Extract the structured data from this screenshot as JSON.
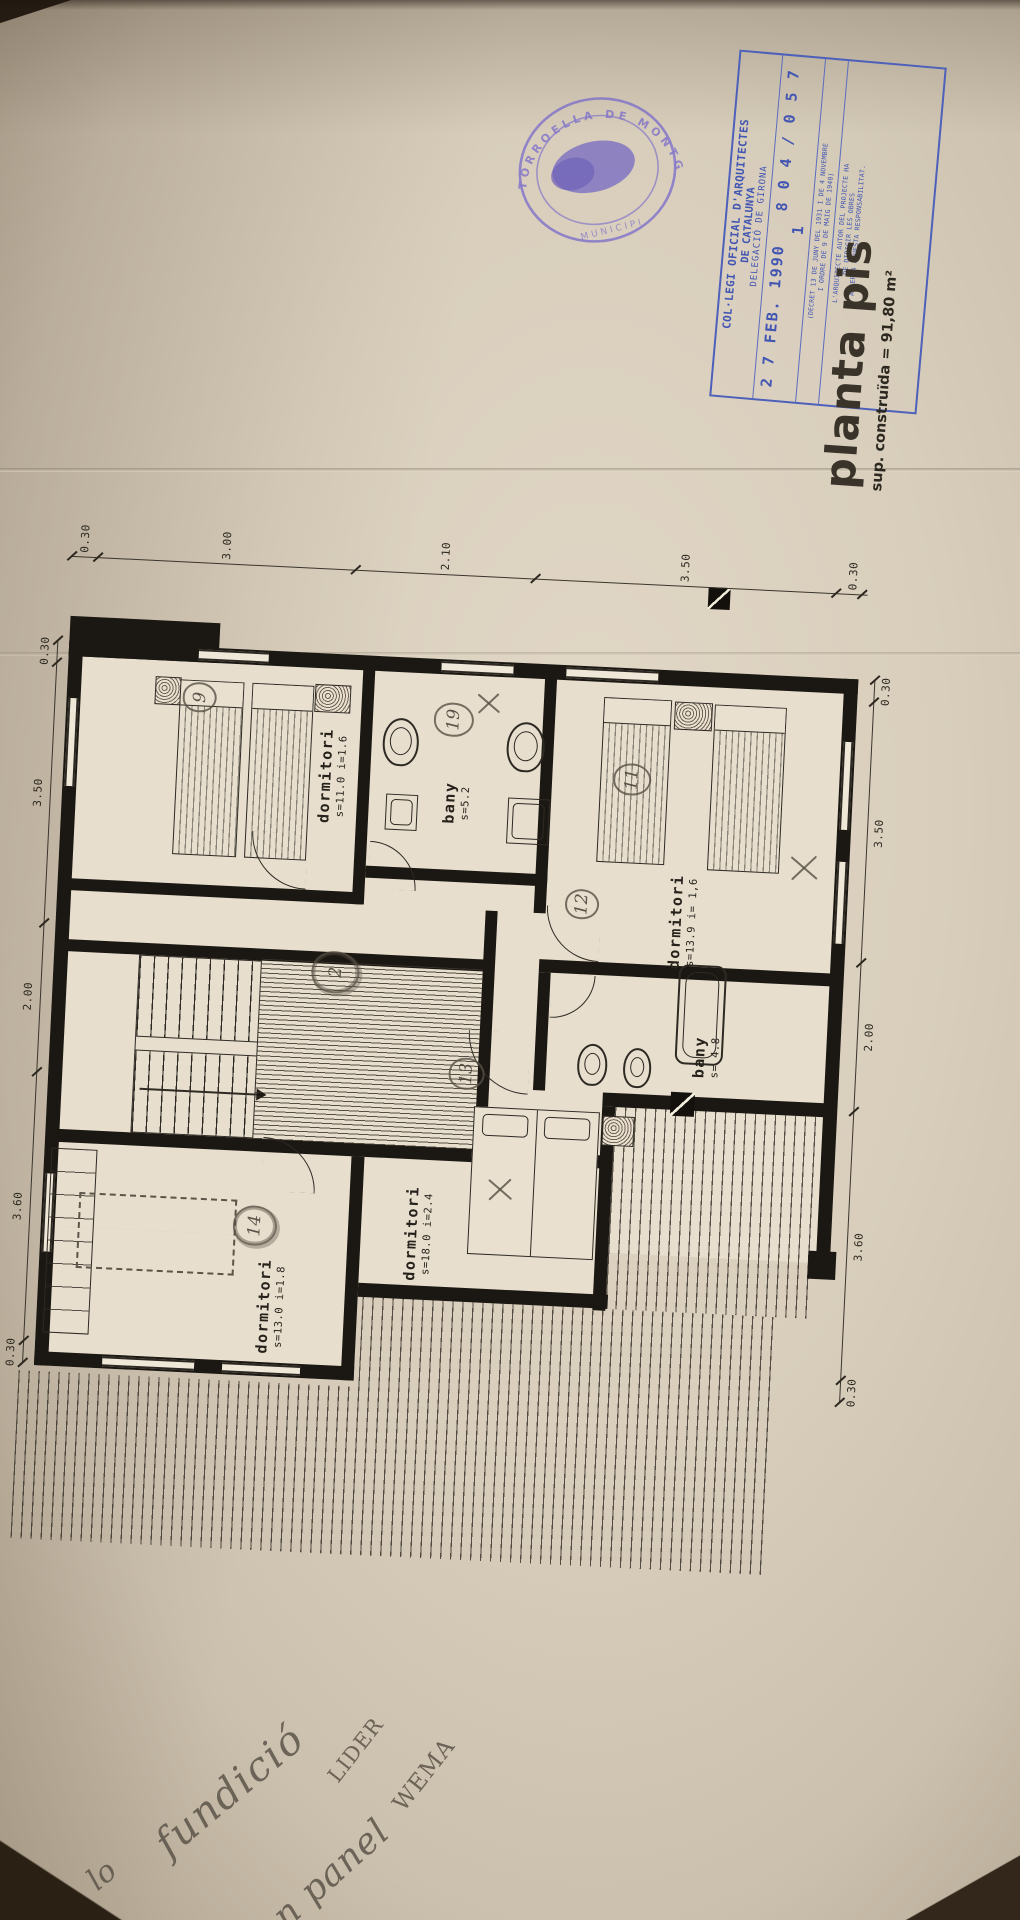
{
  "stamps": {
    "municipal": {
      "arc_text": "TORROELLA DE MONTGRI",
      "bottom_text": "MUNICIPI"
    },
    "college": {
      "org_line1": "COL·LEGI OFICIAL D'ARQUITECTES",
      "org_line2": "DE CATALUNYA",
      "org_line3": "DELEGACIÓ DE GIRONA",
      "date": "2 7 FEB. 1990",
      "number": "8 0 4 / 0 5 7 1",
      "decree_line1": "(DECRET 13 DE JUNY DEL 1931 I DE 4 NOVEMBRE",
      "decree_line2": "I ORDRE DE 9 DE MAIG DE 1940)",
      "resp_line1": "L'ARQUITECTE AUTOR DEL PROJECTE HA",
      "resp_line2": "DE DIRIGIR LES OBRES",
      "resp_line3": "I ACCEPTA AQUESTA RESPONSABILITAT.",
      "accent_color": "#4155b2"
    }
  },
  "title": {
    "main": "planta pis",
    "area": "sup. construïda = 91,80 m²"
  },
  "dims": {
    "top": [
      "0.30",
      "3.00",
      "2.10",
      "3.50",
      "0.30"
    ],
    "left": [
      "0.30",
      "3.50",
      "2.00",
      "3.60",
      "0.30"
    ],
    "right": [
      "0.30",
      "3.50",
      "2.00",
      "3.60",
      "0.30"
    ]
  },
  "rooms": [
    {
      "name": "dormitori",
      "detail": "s=11.0 i=1.6"
    },
    {
      "name": "bany",
      "detail": "s=5.2"
    },
    {
      "name": "dormitori",
      "detail": "s=13.9 i= 1,6"
    },
    {
      "name": "dormitori",
      "detail": "s=13.0 i=1.8"
    },
    {
      "name": "dormitori",
      "detail": "s=18.0 i=2.4"
    },
    {
      "name": "bany",
      "detail": "s= 4.8"
    }
  ],
  "marks": {
    "circled": {
      "c9": "9",
      "c19": "19",
      "c11": "11",
      "c12": "12",
      "c13": "13",
      "c14": "14",
      "scribble": "2"
    }
  },
  "notes": {
    "w1": "fundició",
    "w2": "LIDER",
    "w3": "con panel",
    "w4": "WEMA",
    "w5": "lo"
  }
}
